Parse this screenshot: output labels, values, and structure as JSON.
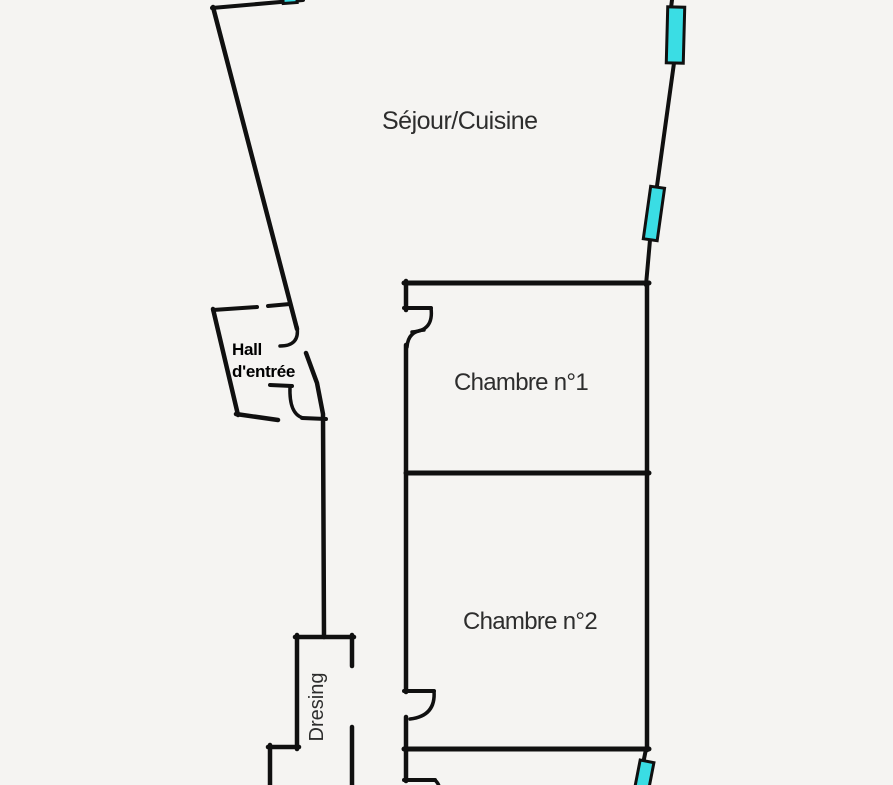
{
  "page": {
    "background": "#f5f4f2"
  },
  "colors": {
    "wall": "#101010",
    "window": "#3adde4",
    "label": "#2d2d2d",
    "hall_label": "#000000"
  },
  "rooms": {
    "sejour": {
      "label": "Séjour/Cuisine"
    },
    "hall": {
      "line1": "Hall",
      "line2": "d'entrée"
    },
    "chambre1": {
      "label": "Chambre n°1"
    },
    "chambre2": {
      "label": "Chambre n°2"
    },
    "dresing": {
      "label": "Dresing"
    }
  },
  "windows": [
    "top-wall-window-icon",
    "right-wall-window-upper-icon",
    "right-wall-window-lower-icon",
    "bottom-right-window-icon"
  ]
}
